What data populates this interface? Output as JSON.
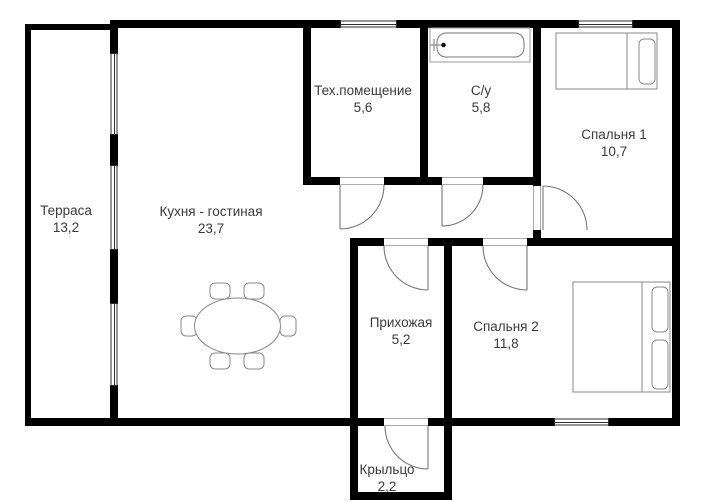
{
  "plan": {
    "rooms": [
      {
        "id": "terrace",
        "label": "Терраса",
        "area": "13,2"
      },
      {
        "id": "kitchen-living",
        "label": "Кухня - гостиная",
        "area": "23,7"
      },
      {
        "id": "tech-room",
        "label": "Тех.помещение",
        "area": "5,6"
      },
      {
        "id": "bathroom",
        "label": "С/у",
        "area": "5,8"
      },
      {
        "id": "bedroom-1",
        "label": "Спальня 1",
        "area": "10,7"
      },
      {
        "id": "hallway",
        "label": "Прихожая",
        "area": "5,2"
      },
      {
        "id": "bedroom-2",
        "label": "Спальня 2",
        "area": "11,8"
      },
      {
        "id": "porch",
        "label": "Крыльцо",
        "area": "2,2"
      }
    ],
    "furniture": [
      "bathtub",
      "single-bed",
      "double-bed",
      "oval-dining-table-6-chairs"
    ],
    "colors": {
      "wall": "#000000",
      "furniture_line": "#8a8a8a",
      "door_line": "#777777",
      "window_line": "#2d2d2d",
      "text": "#3b3b3b",
      "background": "#ffffff"
    }
  }
}
